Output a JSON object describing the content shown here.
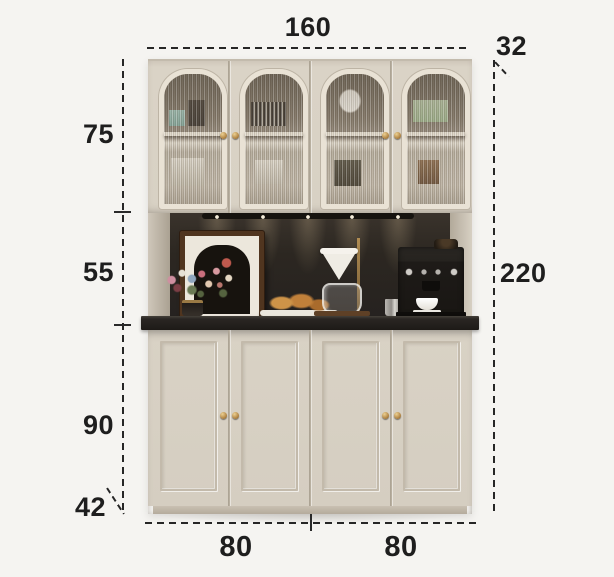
{
  "diagram": {
    "title": "cabinet-dimension-diagram",
    "dimensions": {
      "top_width": "160",
      "upper_depth": "32",
      "upper_cabinet_height": "75",
      "middle_open_height": "55",
      "total_height": "220",
      "lower_cabinet_height": "90",
      "lower_depth": "42",
      "bottom_width_left": "80",
      "bottom_width_right": "80"
    },
    "colors": {
      "background": "#f5f4f1",
      "cabinet_cream": "#d9d2c5",
      "trim_cream": "#e9e2d5",
      "niche_dark": "#2b2723",
      "countertop_dark": "#1d1a17",
      "knob_gold": "#b8924d",
      "annotation_ink": "#1e1e1e"
    },
    "decor_items": [
      "downlights-icon",
      "framed-artwork",
      "flower-bouquet",
      "vase",
      "croissants-on-tray",
      "pour-over-dripper",
      "brass-stand",
      "glass-carafe",
      "milk-pitcher",
      "espresso-machine",
      "coffee-cup"
    ]
  }
}
